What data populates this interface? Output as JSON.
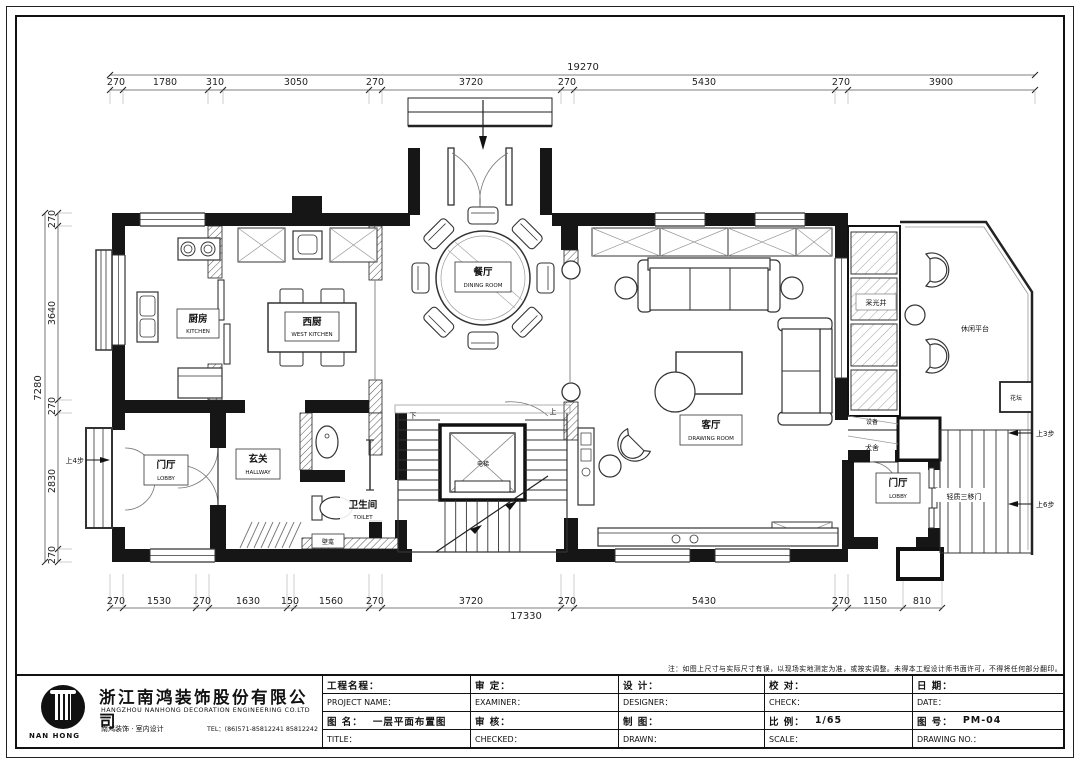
{
  "dimensions": {
    "top_total": "19270",
    "top": [
      "270",
      "1780",
      "310",
      "3050",
      "270",
      "3720",
      "270",
      "5430",
      "270",
      "3900"
    ],
    "bottom_total": "17330",
    "bottom": [
      "270",
      "1530",
      "270",
      "1630",
      "150",
      "1560",
      "270",
      "3720",
      "270",
      "5430",
      "270",
      "1150",
      "810"
    ],
    "left_total": "7280",
    "left": [
      "270",
      "3640",
      "270",
      "2830",
      "270"
    ]
  },
  "rooms": {
    "kitchen": {
      "zh": "厨房",
      "en": "KITCHEN"
    },
    "west_kitchen": {
      "zh": "西厨",
      "en": "WEST KITCHEN"
    },
    "dining": {
      "zh": "餐厅",
      "en": "DINING ROOM"
    },
    "living": {
      "zh": "客厅",
      "en": "DRAWING ROOM"
    },
    "hallway": {
      "zh": "玄关",
      "en": "HALLWAY"
    },
    "lobby_left": {
      "zh": "门厅",
      "en": "LOBBY"
    },
    "lobby_right": {
      "zh": "门厅",
      "en": "LOBBY"
    },
    "toilet": {
      "zh": "卫生间",
      "en": "TOILET"
    },
    "elevator": {
      "zh": "电梯"
    },
    "light_well": {
      "zh": "采光井"
    },
    "leisure_platform": {
      "zh": "休闲平台"
    },
    "flower_bed": {
      "zh": "花坛"
    },
    "equipment": {
      "zh": "设备"
    },
    "dog_house": {
      "zh": "犬舍"
    },
    "niche": {
      "zh": "壁龛"
    }
  },
  "annotations": {
    "up4_steps": "上4步",
    "up3_steps": "上3步",
    "up6_steps": "上6步",
    "up": "上",
    "down": "下",
    "sliding_door": "轻质三移门"
  },
  "title_block": {
    "note": "注：如图上尺寸与实际尺寸有误，以现场实地测定为准，或按实调整。未得本工程设计师书面许可，不得将任何部分翻印。",
    "company_zh": "浙江南鸿装饰股份有限公司",
    "company_en": "HANGZHOU NANHONG DECORATION ENGINEERING CO.LTD",
    "brand": "南鸿装饰 · 室内设计",
    "tel": "TEL：(86)571-85812241  85812242",
    "logo_text": "NAN HONG",
    "fields": {
      "project_zh": "工程名程：",
      "project_en": "PROJECT NAME：",
      "drawing_name_zh": "图  名：",
      "drawing_name_value": "一层平面布置图",
      "title_en": "TITLE：",
      "examiner_zh": "审  定：",
      "examiner_en": "EXAMINER：",
      "checked_zh": "审  核：",
      "checked_en": "CHECKED：",
      "designer_zh": "设  计：",
      "designer_en": "DESIGNER：",
      "drawn_zh": "制  图：",
      "drawn_en": "DRAWN：",
      "check_zh": "校  对：",
      "check_en": "CHECK：",
      "scale_zh": "比  例：",
      "scale_value": "1/65",
      "scale_en": "SCALE：",
      "date_zh": "日  期：",
      "date_en": "DATE：",
      "no_zh": "图  号：",
      "no_value": "PM-04",
      "no_en": "DRAWING NO.："
    }
  }
}
